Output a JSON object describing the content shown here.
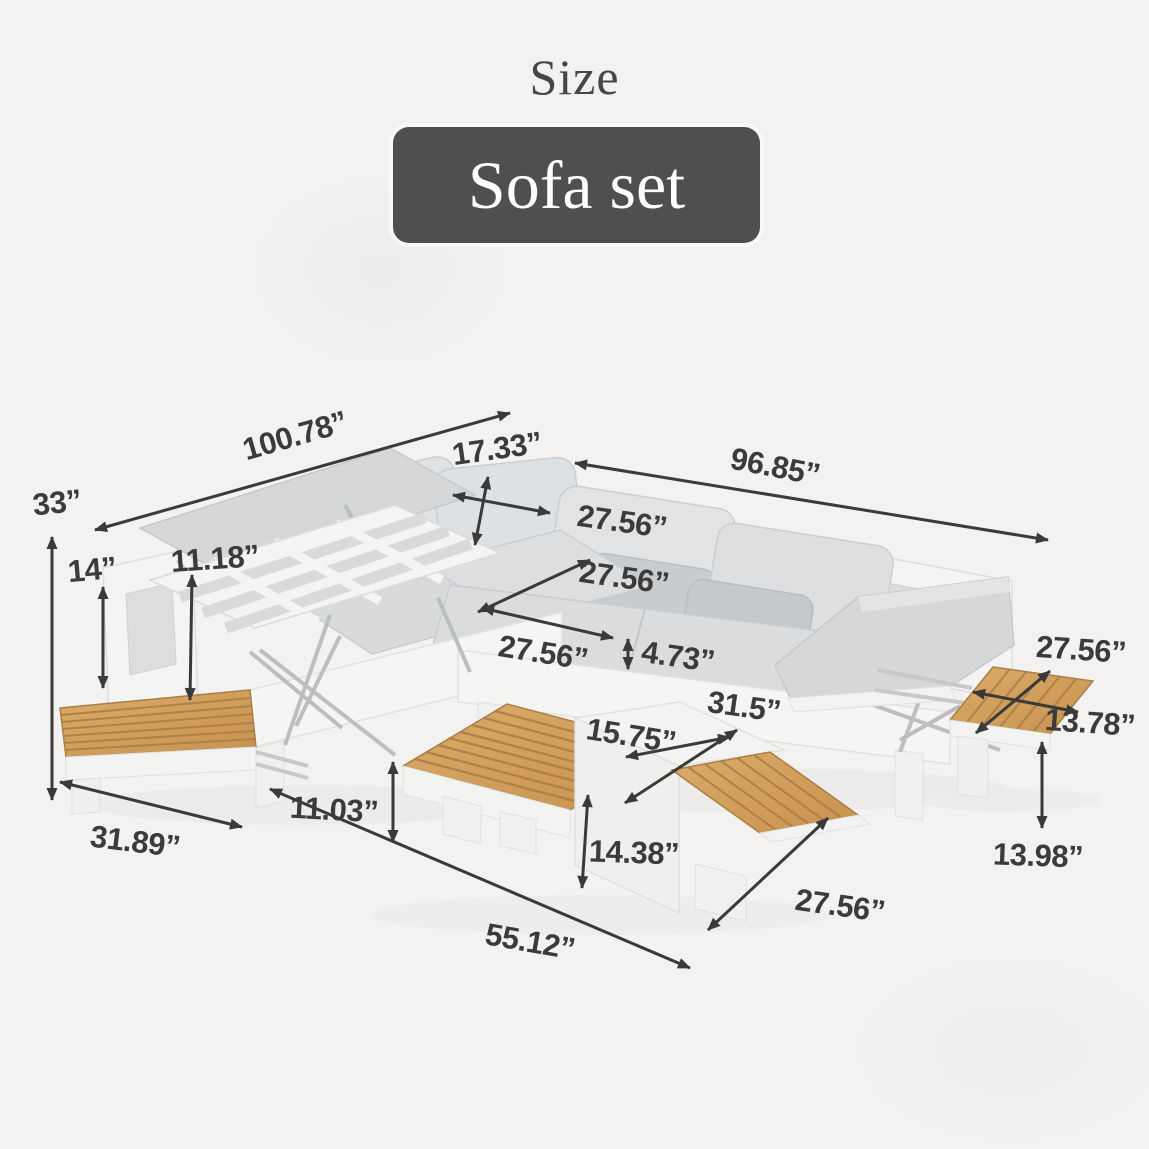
{
  "page": {
    "background_color": "#f3f2f1"
  },
  "header": {
    "title": "Size",
    "product_label": "Sofa set",
    "badge_color": "#504e4f",
    "title_color": "#474546"
  },
  "diagram": {
    "arrow_color": "#3a3a3a",
    "label_color": "#3c3b3a",
    "cushion_color": "#d8dadc",
    "frame_color": "#f4f4f3",
    "wood_color": "#d2a061",
    "dimensions": [
      {
        "name": "sofa-left-length",
        "text": "100.78”"
      },
      {
        "name": "back-cushion-height",
        "text": "17.33”"
      },
      {
        "name": "sofa-right-length",
        "text": "96.85”"
      },
      {
        "name": "total-height",
        "text": "33”"
      },
      {
        "name": "arm-height",
        "text": "14”"
      },
      {
        "name": "backrest-lift-height",
        "text": "11.18”"
      },
      {
        "name": "back-pillow-width-top",
        "text": "27.56”"
      },
      {
        "name": "back-pillow-width-mid",
        "text": "27.56”"
      },
      {
        "name": "seat-depth",
        "text": "27.56”"
      },
      {
        "name": "seat-cushion-thickness",
        "text": "4.73”"
      },
      {
        "name": "side-table-length",
        "text": "27.56”"
      },
      {
        "name": "side-table-width",
        "text": "13.78”"
      },
      {
        "name": "coffee-table-depth",
        "text": "31.5”"
      },
      {
        "name": "nesting-table-width",
        "text": "15.75”"
      },
      {
        "name": "coffee-table-height",
        "text": "11.03”"
      },
      {
        "name": "sofa-depth",
        "text": "31.89”"
      },
      {
        "name": "nesting-table-height",
        "text": "14.38”"
      },
      {
        "name": "coffee-table-length",
        "text": "55.12”"
      },
      {
        "name": "nesting-table-depth",
        "text": "27.56”"
      },
      {
        "name": "side-table-height",
        "text": "13.98”"
      }
    ]
  }
}
